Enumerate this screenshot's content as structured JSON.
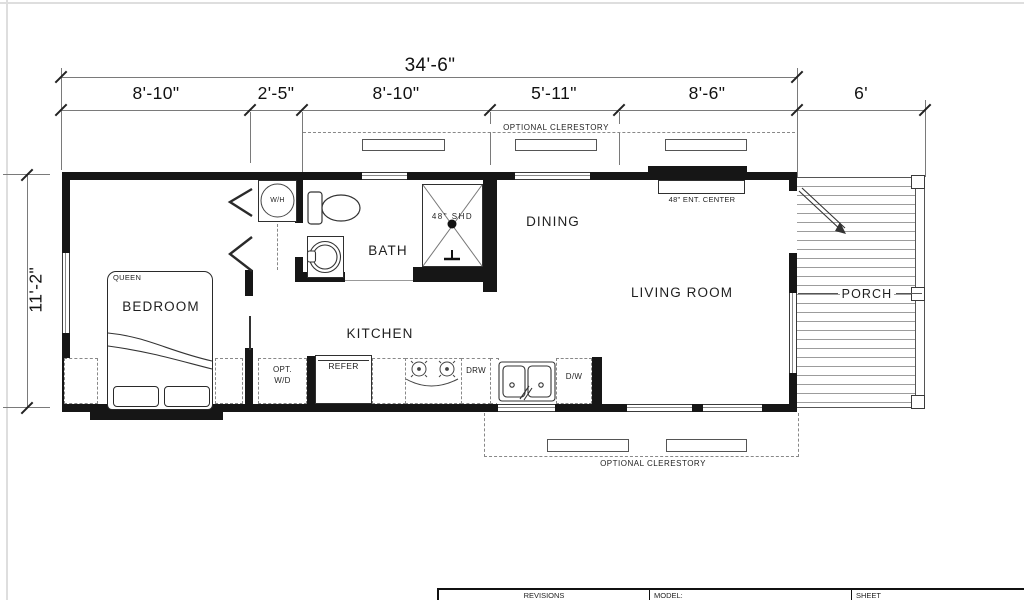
{
  "plan": {
    "dimensions": {
      "overall": "34'-6\"",
      "height": "11'-2\"",
      "segments": [
        "8'-10\"",
        "2'-5\"",
        "8'-10\"",
        "5'-11\"",
        "8'-6\"",
        "6'"
      ]
    },
    "rooms": {
      "bedroom": "BEDROOM",
      "bath": "BATH",
      "kitchen": "KITCHEN",
      "dining": "DINING",
      "living": "LIVING ROOM",
      "porch": "PORCH"
    },
    "fixtures": {
      "queen": "QUEEN",
      "water_heater": "W/H",
      "shower": "48\" SHD",
      "ent_center": "48\" ENT. CENTER",
      "opt_wd_1": "OPT.",
      "opt_wd_2": "W/D",
      "refer": "REFER",
      "drawer": "DRW",
      "dishwasher": "D/W"
    },
    "annotations": {
      "clerestory_top": "OPTIONAL CLERESTORY",
      "clerestory_bottom": "OPTIONAL CLERESTORY"
    },
    "title_block": {
      "revisions": "REVISIONS",
      "model": "MODEL:",
      "sheet": "SHEET"
    },
    "colors": {
      "wall": "#161616",
      "line": "#7a7a7a",
      "text": "#1b1b1b"
    }
  }
}
